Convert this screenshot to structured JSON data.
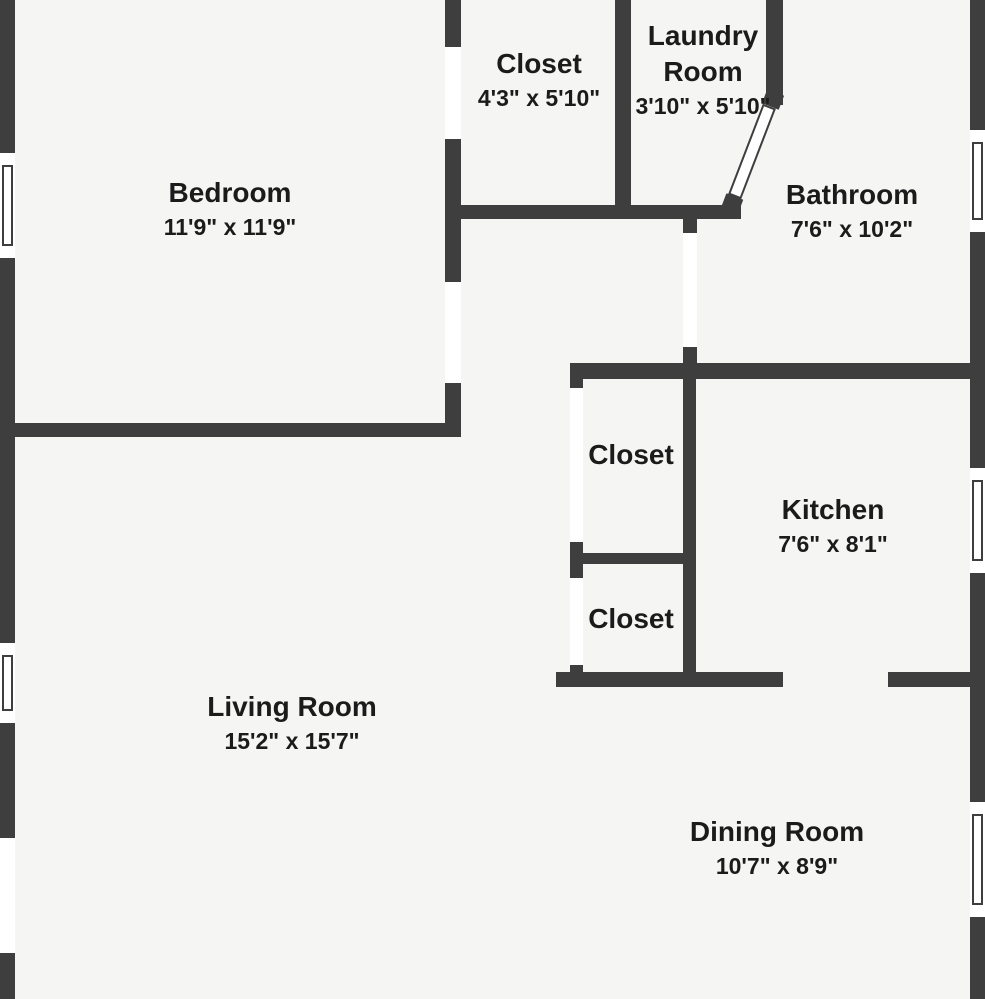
{
  "title": "Apartment floor plan",
  "colors": {
    "background": "#f5f5f4",
    "wall": "#3e3e3e",
    "opening": "#ffffff",
    "text": "#1b1b1b"
  },
  "rooms": [
    {
      "name": "Bedroom",
      "dims": "11'9\" x 11'9\""
    },
    {
      "name": "Closet",
      "dims": "4'3\" x 5'10\""
    },
    {
      "name": "Laundry Room",
      "dims": "3'10\" x 5'10\""
    },
    {
      "name": "Bathroom",
      "dims": "7'6\" x 10'2\""
    },
    {
      "name": "Closet"
    },
    {
      "name": "Kitchen",
      "dims": "7'6\" x 8'1\""
    },
    {
      "name": "Closet"
    },
    {
      "name": "Living Room",
      "dims": "15'2\" x 15'7\""
    },
    {
      "name": "Dining Room",
      "dims": "10'7\" x 8'9\""
    }
  ]
}
